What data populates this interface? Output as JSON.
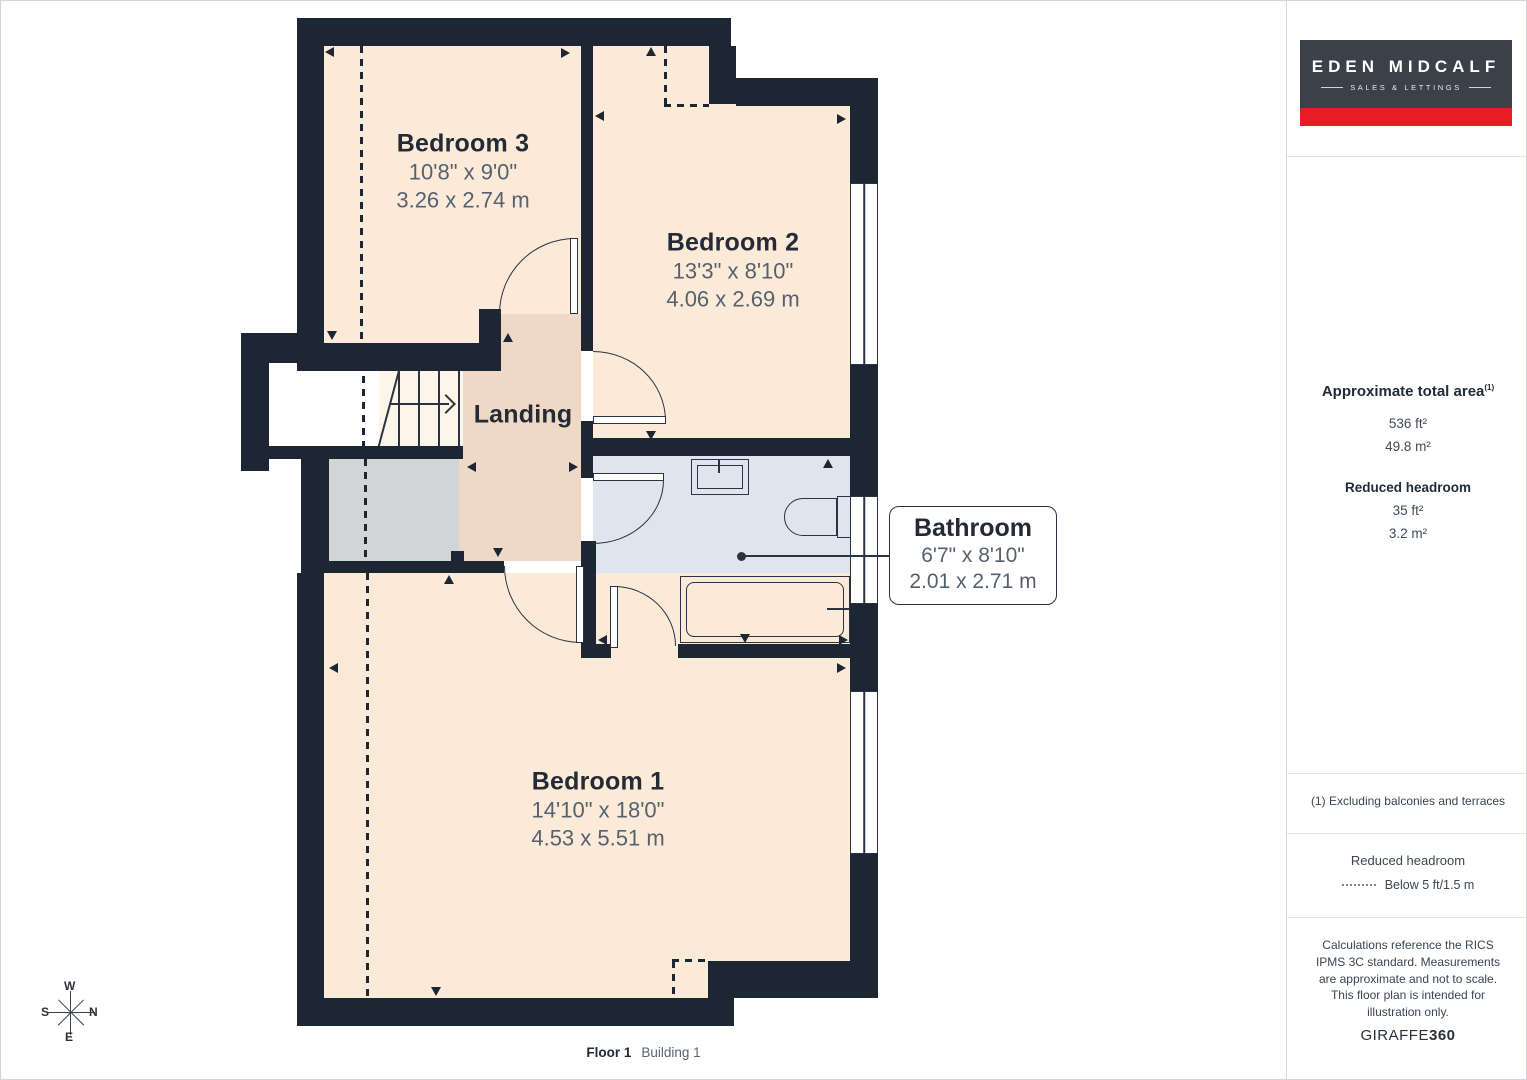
{
  "rooms": {
    "bedroom3": {
      "name": "Bedroom 3",
      "imperial": "10'8\" x 9'0\"",
      "metric": "3.26 x 2.74 m"
    },
    "bedroom2": {
      "name": "Bedroom 2",
      "imperial": "13'3\" x 8'10\"",
      "metric": "4.06 x 2.69 m"
    },
    "bedroom1": {
      "name": "Bedroom 1",
      "imperial": "14'10\" x 18'0\"",
      "metric": "4.53 x 5.51 m"
    },
    "landing": {
      "name": "Landing"
    },
    "bathroom": {
      "name": "Bathroom",
      "imperial": "6'7\" x 8'10\"",
      "metric": "2.01 x 2.71 m"
    }
  },
  "compass": {
    "west": "W",
    "south": "S",
    "north": "N",
    "east": "E"
  },
  "caption": {
    "floor": "Floor 1",
    "building": "Building 1"
  },
  "sidebar": {
    "logo": {
      "title": "EDEN MIDCALF",
      "subtitle": "SALES & LETTINGS"
    },
    "total_area": {
      "title": "Approximate total area",
      "footnote_marker": "(1)",
      "imperial": "536 ft²",
      "metric": "49.8 m²"
    },
    "reduced_headroom": {
      "title": "Reduced headroom",
      "imperial": "35 ft²",
      "metric": "3.2 m²"
    },
    "footnote": "(1) Excluding balconies and terraces",
    "legend": {
      "title": "Reduced headroom",
      "label": "Below 5 ft/1.5 m"
    },
    "disclaimer": "Calculations reference the RICS IPMS 3C standard. Measurements are approximate and not to scale. This floor plan is intended for illustration only.",
    "brand": {
      "name": "GIRAFFE",
      "suffix": "360"
    }
  },
  "colors": {
    "wall": "#1c2733",
    "room_fill": "#fcead9",
    "landing_fill": "#efd8c6",
    "reduced_headroom_fill": "#d3d4d6",
    "bathroom_fill": "#e0e4ee",
    "brand_red": "#e91c25",
    "logo_bg": "#3b4149"
  }
}
